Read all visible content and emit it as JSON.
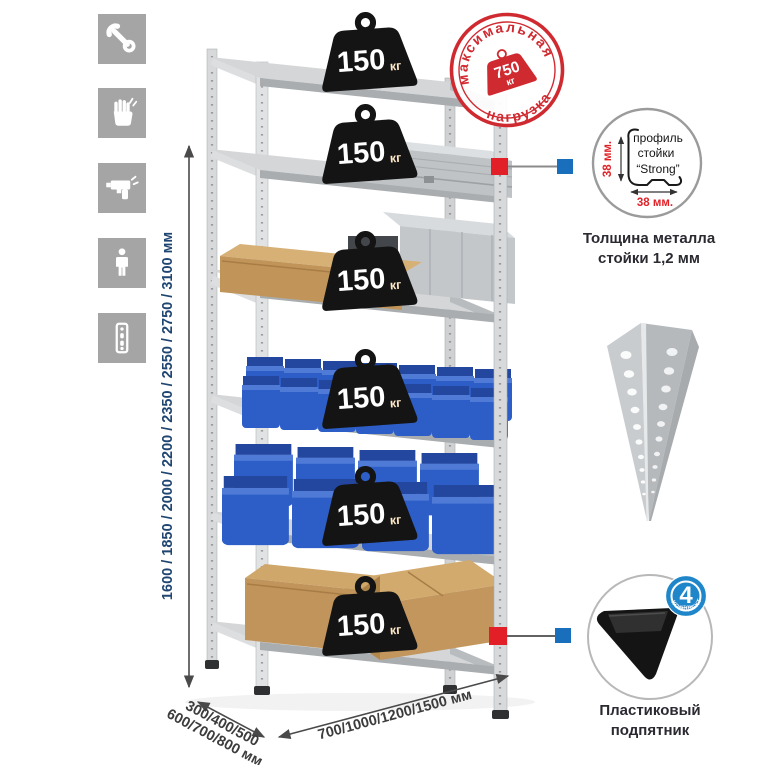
{
  "sidebar": {
    "bg_color": "#a5a5a5",
    "icons": [
      {
        "name": "wrench"
      },
      {
        "name": "work-gloves"
      },
      {
        "name": "drill"
      },
      {
        "name": "person"
      },
      {
        "name": "perforated-post"
      }
    ]
  },
  "dimensions": {
    "height": {
      "label": "1600 / 1850 / 2000 / 2200 / 2350 / 2550 / 2750 / 3100 мм",
      "color": "#1f4571"
    },
    "depth": {
      "line1": "300/400/500",
      "line2": "600/700/800 мм",
      "color": "#3c3c3c"
    },
    "width": {
      "label": "700/1000/1200/1500 мм",
      "color": "#3c3c3c"
    }
  },
  "illustration": {
    "shelf_count": 6,
    "shelf_load": {
      "value": "150",
      "unit": "кг"
    },
    "max_load_stamp": {
      "arc_top": "максимальная",
      "arc_bottom": "нагрузка",
      "value": "750",
      "unit": "кг",
      "color": "#d02a31"
    }
  },
  "details": {
    "profile": {
      "line1": "профиль",
      "line2": "стойки",
      "line3": "“Strong”",
      "vertical_dim": "38 мм.",
      "horizontal_dim": "38 мм.",
      "dim_color": "#e02228",
      "caption": "Толщина металла стойки 1,2 мм"
    },
    "foot": {
      "caption": "Пластиковый подпятник",
      "badge": {
        "count": "4",
        "small_text": "штуки",
        "arc_text": "В КОМПЛЕКТЕ",
        "color": "#1f86c9"
      }
    }
  },
  "colors": {
    "bin_blue": "#2d5ec7",
    "cardboard": "#c49a5f",
    "metal": "#d4d6d8",
    "connector_red": "#e21e26",
    "connector_blue": "#1a6fbd"
  }
}
